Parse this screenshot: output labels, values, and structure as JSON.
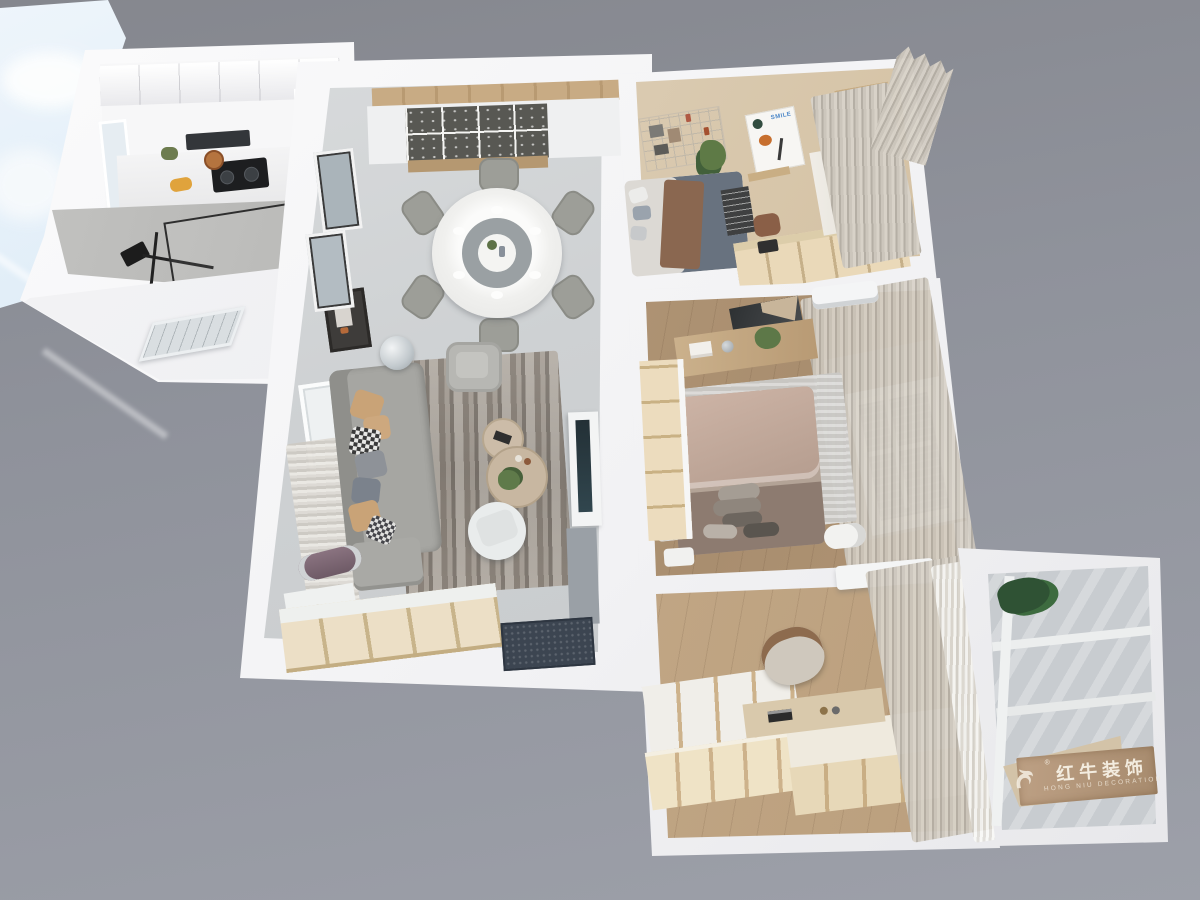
{
  "watermark": {
    "brand_cn": "红牛装饰",
    "brand_en": "HONG NIU DECORATION",
    "registered_mark": "®",
    "board_color": "#b49879",
    "text_color": "#f3ecdf"
  },
  "bedroom_poster": {
    "title": "SMILE",
    "title_color": "#4a86c8"
  },
  "palette": {
    "background_top": "#86888f",
    "background_bottom": "#9da0a9",
    "wall_white": "#f4f4f6",
    "living_floor_tile": "#ced1d3",
    "wood_master_bedroom": "#b2956f",
    "wood_study": "#c2a784",
    "cream_cabinet": "#eadcba",
    "sofa_gray": "#a6a6a2",
    "rug_gray_brown": "#958d84",
    "curtain_beige": "#ccc5ba",
    "doormat_dark": "#3c4551",
    "tv_dark": "#2d3a40",
    "sky_blue": "#bfd7ee",
    "shower_tile": "#b9b9b7",
    "dining_table_center": "#9aa0a3",
    "bed_master_duvet": "#c9b0a2",
    "bed_small_blanket": "#68727f",
    "bed_small_throw": "#8a6750"
  }
}
